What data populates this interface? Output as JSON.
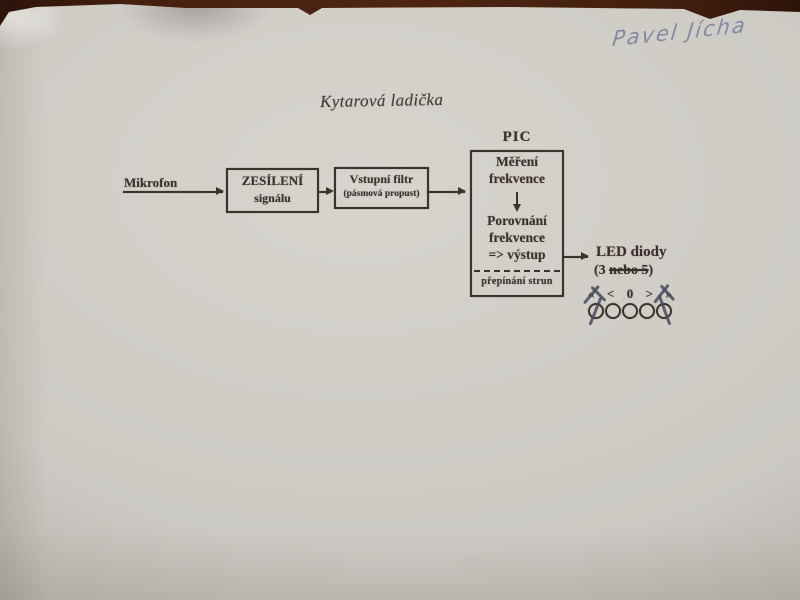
{
  "page": {
    "handwritten_name": "Pavel Jícha",
    "title": "Kytarová ladička"
  },
  "diagram": {
    "mikrofon_label": "Mikrofon",
    "amp_box": {
      "line1": "ZESÍLENÍ",
      "line2": "signálu"
    },
    "filter_box": {
      "line1": "Vstupní filtr",
      "line2": "(pásmová propust)"
    },
    "pic": {
      "label": "PIC",
      "measure_line1": "Měření",
      "measure_line2": "frekvence",
      "compare_line1": "Porovnání",
      "compare_line2": "frekvence",
      "compare_line3": "=> výstup",
      "bottom_label": "přepínání strun"
    },
    "led": {
      "label": "LED diody",
      "count_prefix": "(3 ",
      "count_struck": "nebo 5",
      "count_suffix": ")",
      "symbols": [
        "«",
        "<",
        "0",
        ">",
        "»"
      ],
      "circle_count": 5
    }
  },
  "colors": {
    "table_background": "#44200f",
    "paper": "#cfccc6",
    "ink_printed": "#39302b",
    "ink_handwriting": "#78849f",
    "ink_pen_marks": "#454b60"
  }
}
